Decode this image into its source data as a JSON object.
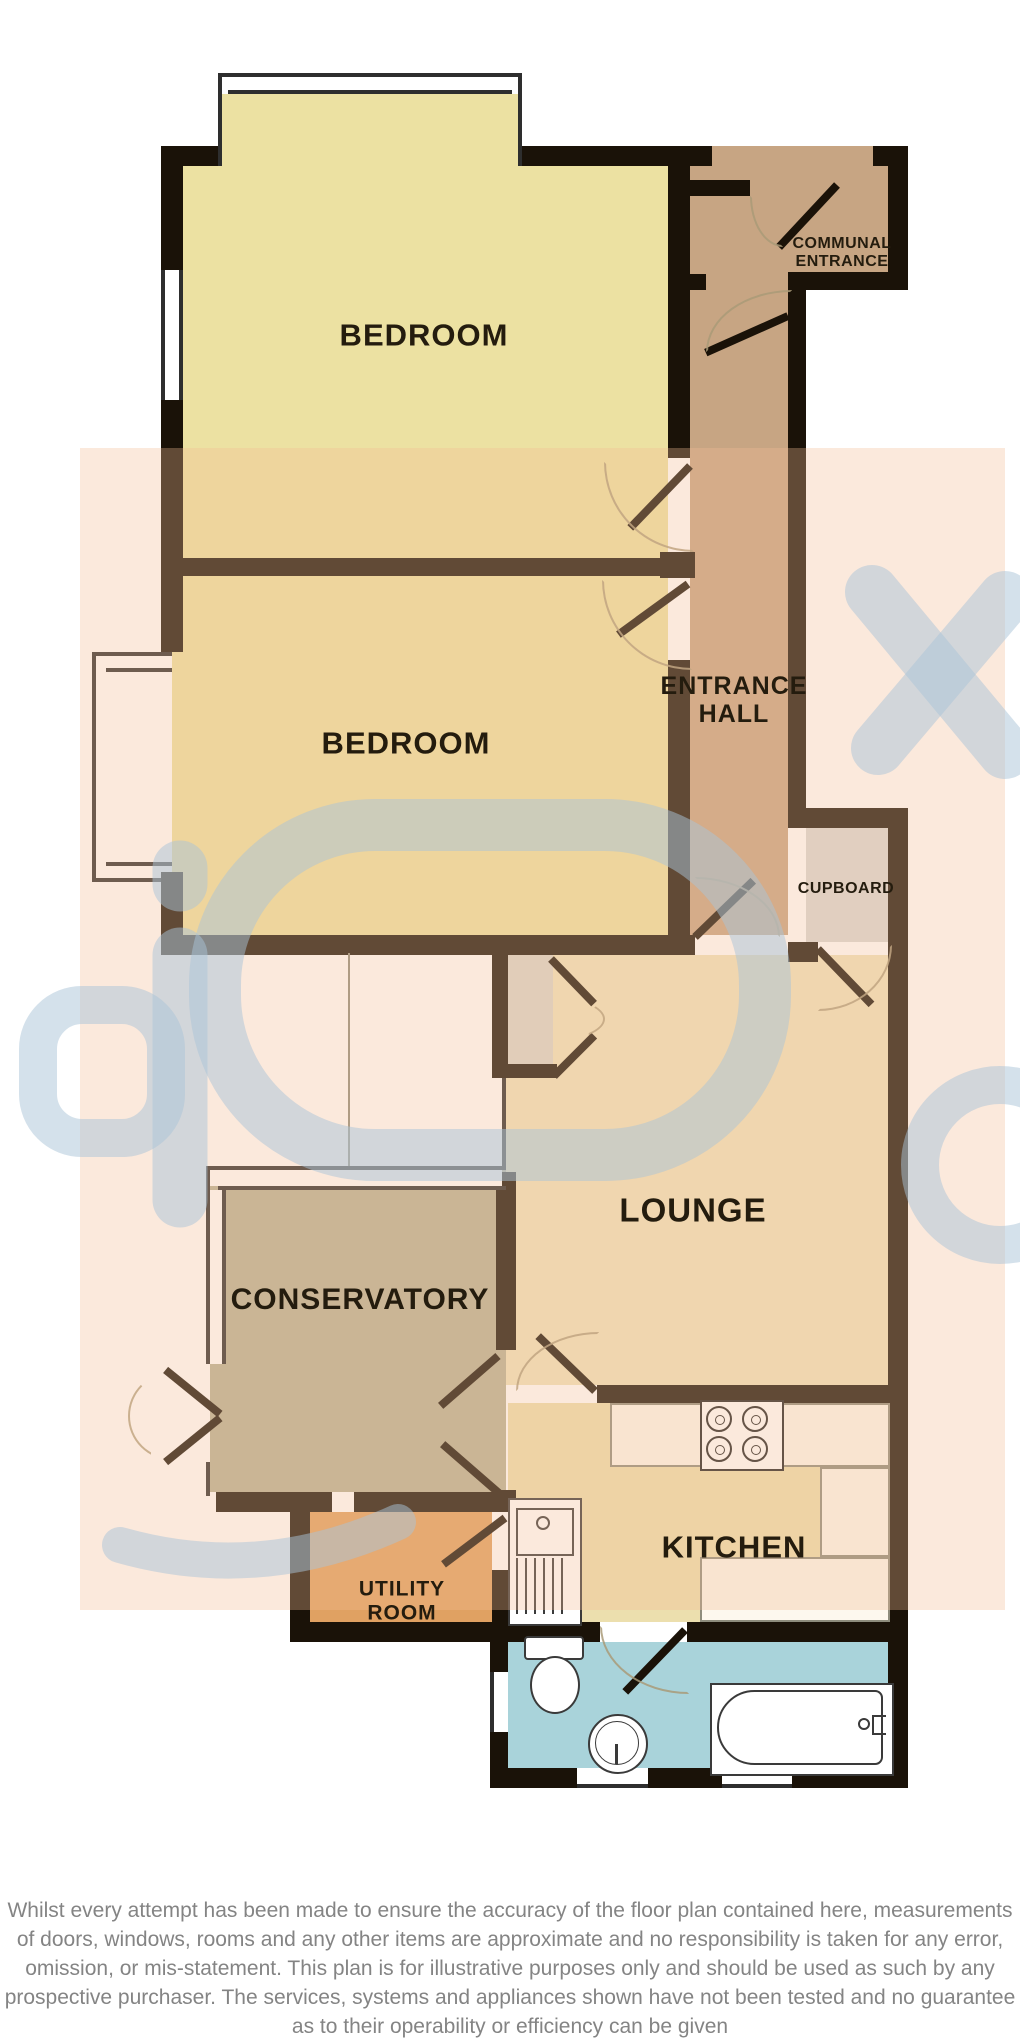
{
  "plan": {
    "rooms": {
      "bedroom1": {
        "label": "BEDROOM"
      },
      "bedroom2": {
        "label": "BEDROOM"
      },
      "communal_entrance": {
        "label": "COMMUNAL\nENTRANCE"
      },
      "entrance_hall": {
        "label": "ENTRANCE\nHALL"
      },
      "cupboard": {
        "label": "CUPBOARD"
      },
      "lounge": {
        "label": "LOUNGE"
      },
      "conservatory": {
        "label": "CONSERVATORY"
      },
      "utility_room": {
        "label": "UTILITY\nROOM"
      },
      "kitchen": {
        "label": "KITCHEN"
      }
    },
    "colors": {
      "wall": "#1a1208",
      "bedroom": "#ece1a2",
      "hall_tan": "#c7a583",
      "cupboard_gray": "#d8d8d6",
      "lounge_cream": "#efe3bd",
      "kitchen_floor": "#ecdfae",
      "conservatory_sage": "#b7b295",
      "utility_orange": "#e0a162",
      "bathroom_blue": "#a9d3da",
      "counter_white": "#fdf8ee",
      "watermark_blue": "#a9c3d8",
      "watermark_peach": "#f4bc94",
      "disclaimer_gray": "#848484"
    },
    "disclaimer": {
      "lines": [
        "Whilst every attempt has been made to ensure the accuracy of the floor plan contained here, measurements",
        "of doors, windows, rooms and any other items are approximate and no responsibility is taken for any error,",
        "omission, or mis-statement. This plan is for illustrative purposes only and should be used as such by any",
        "prospective purchaser. The services, systems and appliances shown have not been tested and no guarantee",
        "as to their operability or efficiency can be given"
      ],
      "credit": "Made with Metropix ©2018"
    }
  }
}
